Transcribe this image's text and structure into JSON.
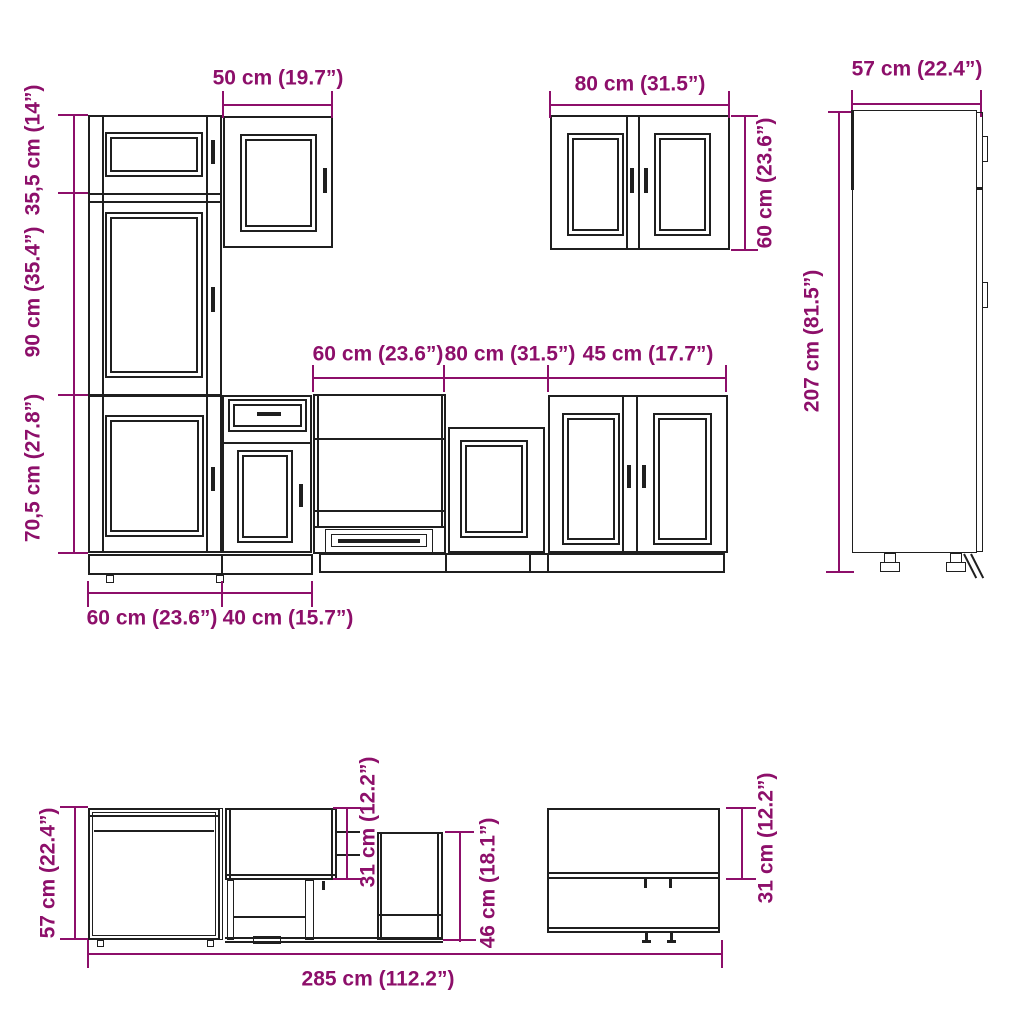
{
  "colors": {
    "dimension_text": "#8d0f6a",
    "line": "#1f1f1f",
    "background": "#ffffff"
  },
  "labels": {
    "wall_cabinet_50_width": "50 cm (19.7”)",
    "pantry_upper_height": "35,5 cm (14”)",
    "pantry_middle_height": "90 cm (35.4”)",
    "pantry_lower_height": "70,5 cm (27.8”)",
    "wall_cabinet_80_width": "80 cm (31.5”)",
    "wall_cabinet_80_height": "60 cm (23.6”)",
    "tall_cabinet_depth": "57 cm (22.4”)",
    "tall_cabinet_height": "207 cm (81.5”)",
    "oven_cabinet_width": "60 cm (23.6”)",
    "base_cabinet_80_width": "80 cm (31.5”)",
    "base_cabinet_45_width": "45 cm (17.7”)",
    "bottom_row_60_width": "60 cm (23.6”)",
    "bottom_row_40_width": "40 cm (15.7”)",
    "plan_depth_57": "57 cm (22.4”)",
    "plan_wall_depth_31_left": "31 cm (12.2”)",
    "plan_base_depth_46": "46 cm (18.1”)",
    "plan_wall_depth_31_right": "31 cm (12.2”)",
    "total_run_width": "285 cm (112.2”)"
  }
}
